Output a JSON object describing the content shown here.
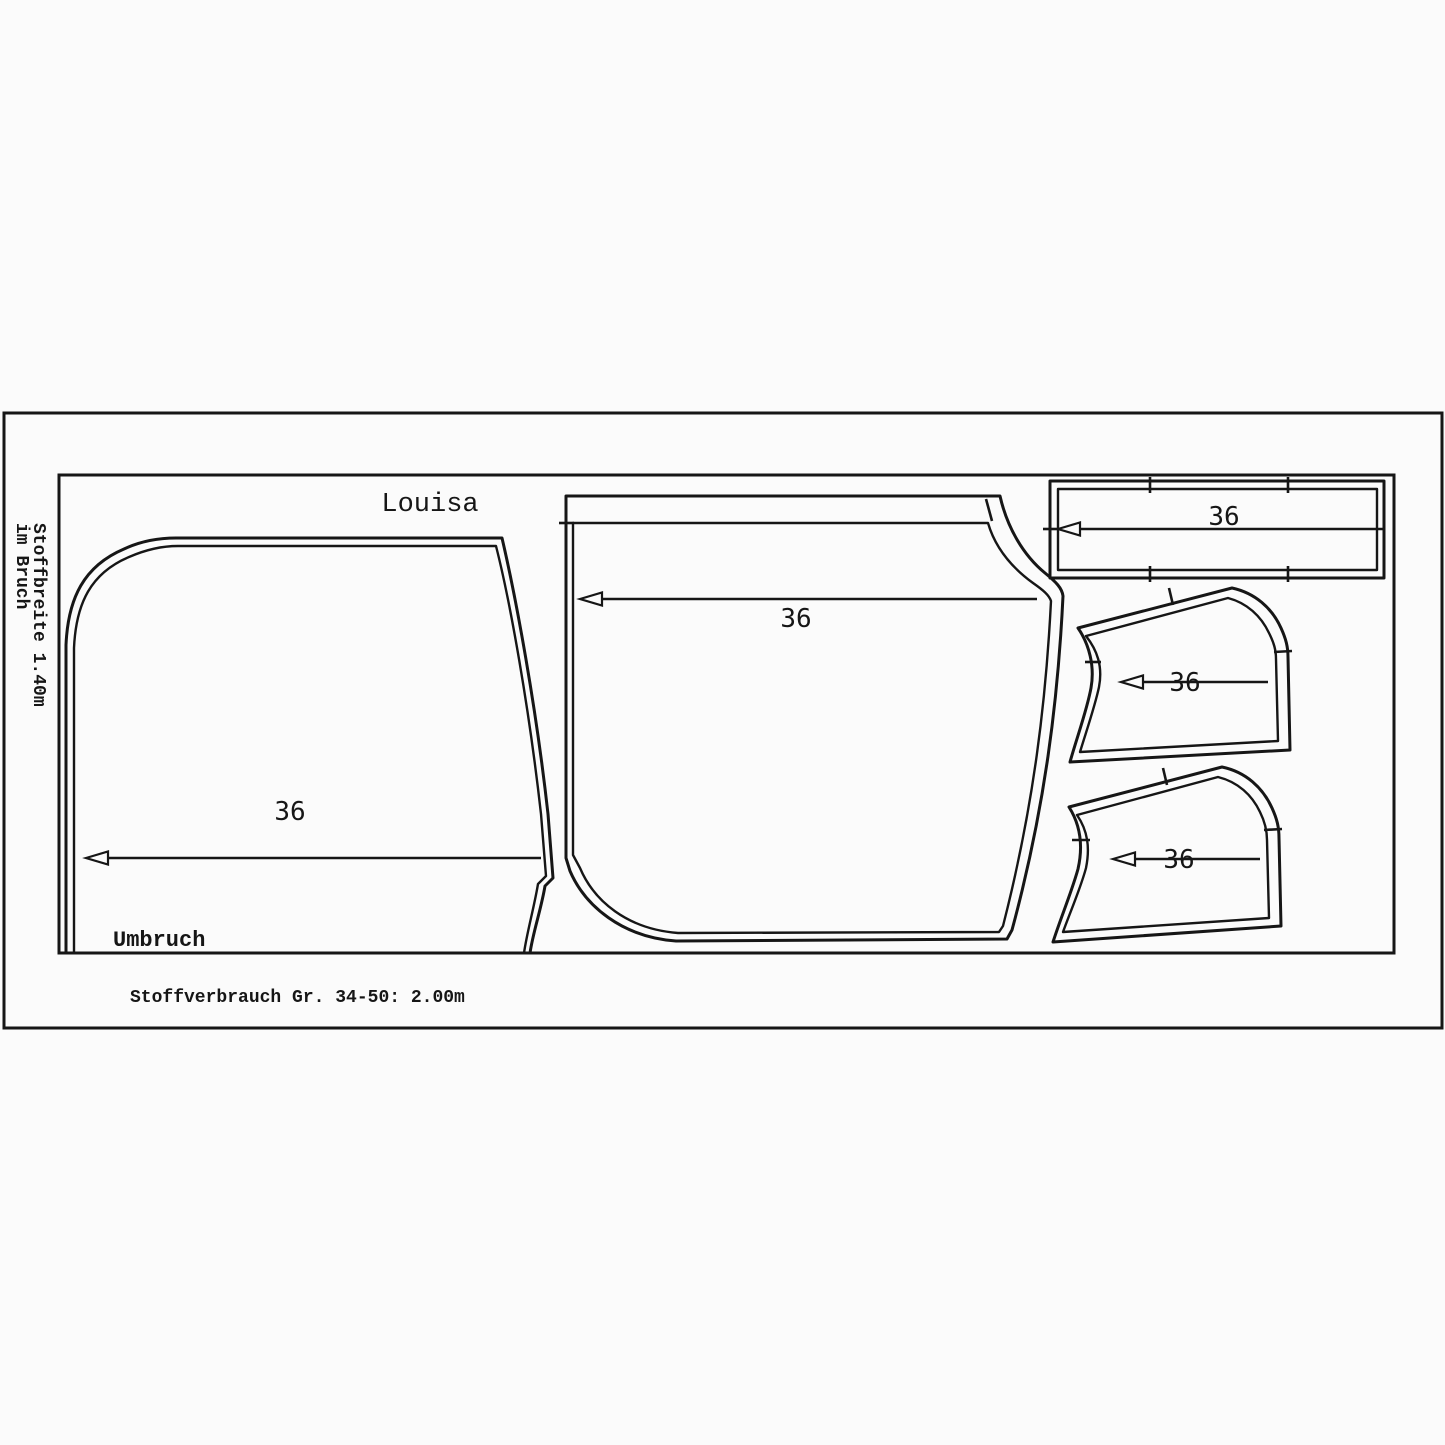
{
  "page": {
    "background": "#fbfbfb",
    "line_color": "#161616"
  },
  "layout": {
    "title": "Louisa",
    "fabric_width_label": "Stoffbreite 1.40m",
    "fold_note_label": "im Bruch",
    "fold_edge_label": "Umbruch",
    "fabric_usage_label": "Stoffverbrauch Gr. 34-50: 2.00m",
    "pieces": {
      "back": {
        "size": "36"
      },
      "front": {
        "size": "36"
      },
      "waistband": {
        "size": "36"
      },
      "pocket_upper": {
        "size": "36"
      },
      "pocket_lower": {
        "size": "36"
      }
    }
  }
}
